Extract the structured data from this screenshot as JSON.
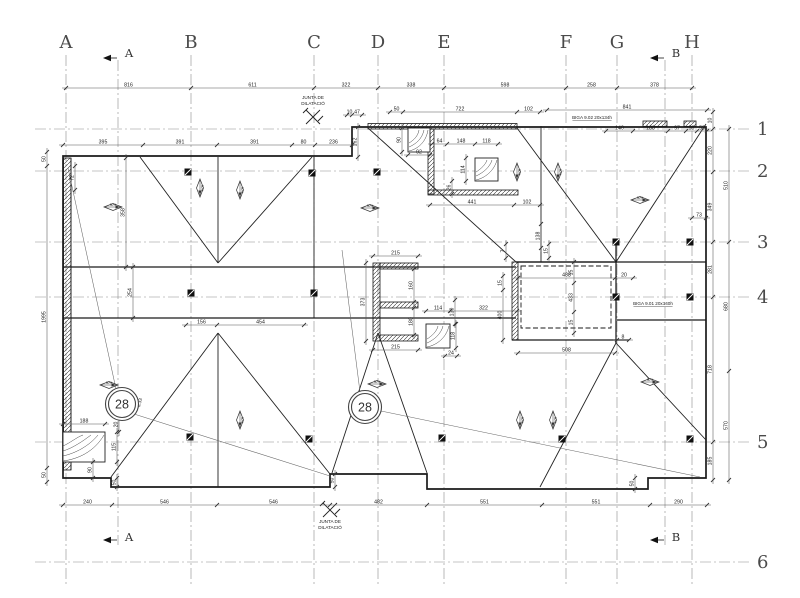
{
  "drawing": {
    "grid": {
      "cols": [
        {
          "l": "A",
          "x": 66
        },
        {
          "l": "B",
          "x": 191
        },
        {
          "l": "C",
          "x": 314
        },
        {
          "l": "D",
          "x": 378
        },
        {
          "l": "E",
          "x": 444
        },
        {
          "l": "F",
          "x": 566
        },
        {
          "l": "G",
          "x": 617
        },
        {
          "l": "H",
          "x": 692
        }
      ],
      "rows": [
        {
          "l": "1",
          "y": 129
        },
        {
          "l": "2",
          "y": 171
        },
        {
          "l": "3",
          "y": 242
        },
        {
          "l": "4",
          "y": 297
        },
        {
          "l": "5",
          "y": 442
        },
        {
          "l": "6",
          "y": 562
        }
      ]
    },
    "sections": [
      {
        "l": "A",
        "x": 118
      },
      {
        "l": "B",
        "x": 665
      }
    ],
    "chains": [
      {
        "dir": "h",
        "pos": 88,
        "t": [
          66,
          191,
          314,
          378,
          444,
          566,
          617,
          692
        ],
        "l": [
          "816",
          "611",
          "322",
          "338",
          "598",
          "258",
          "378"
        ]
      },
      {
        "dir": "h",
        "pos": 145,
        "t": [
          63,
          143,
          217,
          292,
          315,
          352
        ],
        "l": [
          "395",
          "391",
          "391",
          "80",
          "236"
        ]
      },
      {
        "dir": "h",
        "pos": 115,
        "t": [
          347,
          352,
          362
        ],
        "l": [
          "10",
          "47"
        ]
      },
      {
        "dir": "h",
        "pos": 112,
        "t": [
          390,
          403,
          517,
          540
        ],
        "l": [
          "50",
          "722",
          "102"
        ]
      },
      {
        "dir": "h",
        "pos": 110,
        "t": [
          547,
          707
        ],
        "l": [
          "841"
        ]
      },
      {
        "dir": "h",
        "pos": 131,
        "t": [
          606,
          633,
          668,
          686,
          697,
          707
        ],
        "l": [
          "140",
          "188",
          "97",
          "58",
          "53"
        ]
      },
      {
        "dir": "h",
        "pos": 505,
        "t": [
          63,
          112,
          217,
          330,
          427,
          542,
          650,
          707
        ],
        "l": [
          "240",
          "546",
          "546",
          "482",
          "551",
          "551",
          "290"
        ]
      },
      {
        "dir": "h",
        "pos": 205,
        "t": [
          430,
          514,
          540
        ],
        "l": [
          "441",
          "102"
        ]
      },
      {
        "dir": "h",
        "pos": 325,
        "t": [
          186,
          217,
          304
        ],
        "l": [
          "156",
          "454"
        ]
      },
      {
        "dir": "h",
        "pos": 311,
        "t": [
          426,
          450,
          517
        ],
        "l": [
          "114",
          "322"
        ]
      },
      {
        "dir": "h",
        "pos": 144,
        "t": [
          432,
          447,
          475,
          498
        ],
        "l": [
          "64",
          "148",
          "118"
        ]
      },
      {
        "dir": "h",
        "pos": 424,
        "t": [
          63,
          105
        ],
        "l": [
          "188"
        ]
      },
      {
        "dir": "h",
        "pos": 256,
        "t": [
          373,
          418
        ],
        "l": [
          "215"
        ]
      },
      {
        "dir": "h",
        "pos": 350,
        "t": [
          373,
          418
        ],
        "l": [
          "215"
        ]
      },
      {
        "dir": "h",
        "pos": 278,
        "t": [
          518,
          615,
          633
        ],
        "l": [
          "488",
          "20"
        ]
      },
      {
        "dir": "h",
        "pos": 218,
        "t": [
          692,
          706
        ],
        "l": [
          "73"
        ]
      },
      {
        "dir": "h",
        "pos": 356,
        "t": [
          445,
          457
        ],
        "l": [
          "24"
        ]
      },
      {
        "dir": "h",
        "pos": 155,
        "t": [
          408,
          430
        ],
        "l": [
          "92"
        ]
      },
      {
        "dir": "h",
        "pos": 353,
        "t": [
          518,
          615
        ],
        "l": [
          "508"
        ]
      },
      {
        "dir": "h",
        "pos": 340,
        "t": [
          617,
          629
        ],
        "l": [
          "8"
        ]
      },
      {
        "dir": "v",
        "pos": 47,
        "t": [
          152,
          166,
          468,
          482
        ],
        "l": [
          "50",
          "1995",
          "50"
        ]
      },
      {
        "dir": "v",
        "pos": 713,
        "t": [
          112,
          129,
          172,
          242,
          297,
          442,
          480
        ],
        "l": [
          "10",
          "220",
          "349",
          "281",
          "718",
          "185"
        ]
      },
      {
        "dir": "v",
        "pos": 729,
        "t": [
          129,
          242,
          371,
          480
        ],
        "l": [
          "510",
          "680",
          "570"
        ]
      },
      {
        "dir": "v",
        "pos": 126,
        "t": [
          158,
          267
        ],
        "l": [
          "358"
        ]
      },
      {
        "dir": "v",
        "pos": 133,
        "t": [
          267,
          318
        ],
        "l": [
          "254"
        ]
      },
      {
        "dir": "v",
        "pos": 366,
        "t": [
          263,
          341
        ],
        "l": [
          "373"
        ]
      },
      {
        "dir": "v",
        "pos": 414,
        "t": [
          269,
          302
        ],
        "l": [
          "160"
        ]
      },
      {
        "dir": "v",
        "pos": 414,
        "t": [
          308,
          335
        ],
        "l": [
          "180"
        ]
      },
      {
        "dir": "v",
        "pos": 402,
        "t": [
          128,
          152
        ],
        "l": [
          "90"
        ]
      },
      {
        "dir": "v",
        "pos": 466,
        "t": [
          158,
          181
        ],
        "l": [
          "114"
        ]
      },
      {
        "dir": "v",
        "pos": 456,
        "t": [
          324,
          348
        ],
        "l": [
          "118"
        ]
      },
      {
        "dir": "v",
        "pos": 455,
        "t": [
          300,
          324
        ],
        "l": [
          "130"
        ]
      },
      {
        "dir": "v",
        "pos": 358,
        "t": [
          127,
          157
        ],
        "l": [
          "162"
        ]
      },
      {
        "dir": "v",
        "pos": 119,
        "t": [
          417,
          432
        ],
        "l": [
          "20"
        ]
      },
      {
        "dir": "v",
        "pos": 117,
        "t": [
          432,
          462
        ],
        "l": [
          "115"
        ]
      },
      {
        "dir": "v",
        "pos": 93,
        "t": [
          462,
          478
        ],
        "l": [
          "90"
        ]
      },
      {
        "dir": "v",
        "pos": 117,
        "t": [
          478,
          487
        ],
        "l": [
          "50"
        ]
      },
      {
        "dir": "v",
        "pos": 335,
        "t": [
          474,
          487
        ],
        "l": [
          "50"
        ]
      },
      {
        "dir": "v",
        "pos": 635,
        "t": [
          478,
          489
        ],
        "l": [
          "50"
        ]
      },
      {
        "dir": "v",
        "pos": 574,
        "t": [
          262,
          283,
          312,
          333
        ],
        "l": [
          "15",
          "433",
          "15"
        ]
      },
      {
        "dir": "v",
        "pos": 503,
        "t": [
          276,
          290,
          340
        ],
        "l": [
          "15",
          "400"
        ]
      },
      {
        "dir": "v",
        "pos": 506,
        "t": [
          244,
          258
        ],
        "l": [
          "7"
        ]
      },
      {
        "dir": "v",
        "pos": 549,
        "t": [
          244,
          258
        ],
        "l": [
          "15"
        ]
      },
      {
        "dir": "v",
        "pos": 541,
        "t": [
          224,
          248
        ],
        "l": [
          "138"
        ]
      },
      {
        "dir": "v",
        "pos": 452,
        "t": [
          181,
          194
        ],
        "l": [
          "26"
        ]
      },
      {
        "dir": "v",
        "pos": 75,
        "t": [
          166,
          190
        ],
        "l": [
          "72"
        ]
      }
    ],
    "notes": [
      {
        "t": "JUNTA DE",
        "x": 313,
        "y": 99
      },
      {
        "t": "DILATACIÓ",
        "x": 313,
        "y": 105
      },
      {
        "t": "JUNTA DE",
        "x": 330,
        "y": 523
      },
      {
        "t": "DILATACIÓ",
        "x": 330,
        "y": 529
      },
      {
        "t": "BIGA 9.02 20x134h",
        "x": 592,
        "y": 119,
        "u": 1
      },
      {
        "t": "BIGA 9.01 20x140h",
        "x": 653,
        "y": 305,
        "u": 1
      },
      {
        "t": "6.33",
        "x": 141,
        "y": 403,
        "r": 1
      }
    ],
    "slope_label": "30%",
    "slopes": [
      {
        "x": 113,
        "y": 207,
        "v": 0
      },
      {
        "x": 200,
        "y": 188,
        "v": 1
      },
      {
        "x": 240,
        "y": 190,
        "v": 1
      },
      {
        "x": 370,
        "y": 208,
        "v": 0
      },
      {
        "x": 517,
        "y": 172,
        "v": 1
      },
      {
        "x": 558,
        "y": 172,
        "v": 1
      },
      {
        "x": 640,
        "y": 200,
        "v": 0
      },
      {
        "x": 109,
        "y": 385,
        "v": 0
      },
      {
        "x": 377,
        "y": 384,
        "v": 0
      },
      {
        "x": 240,
        "y": 420,
        "v": 1
      },
      {
        "x": 520,
        "y": 420,
        "v": 1
      },
      {
        "x": 553,
        "y": 420,
        "v": 1
      },
      {
        "x": 650,
        "y": 382,
        "v": 0
      }
    ],
    "squares": [
      [
        188,
        172
      ],
      [
        312,
        173
      ],
      [
        377,
        172
      ],
      [
        191,
        293
      ],
      [
        314,
        293
      ],
      [
        616,
        242
      ],
      [
        690,
        242
      ],
      [
        616,
        297
      ],
      [
        690,
        297
      ],
      [
        190,
        437
      ],
      [
        309,
        439
      ],
      [
        442,
        438
      ],
      [
        562,
        439
      ],
      [
        690,
        439
      ]
    ],
    "detail_bubbles": [
      {
        "t": "28",
        "x": 122,
        "y": 404
      },
      {
        "t": "28",
        "x": 365,
        "y": 407
      }
    ]
  }
}
